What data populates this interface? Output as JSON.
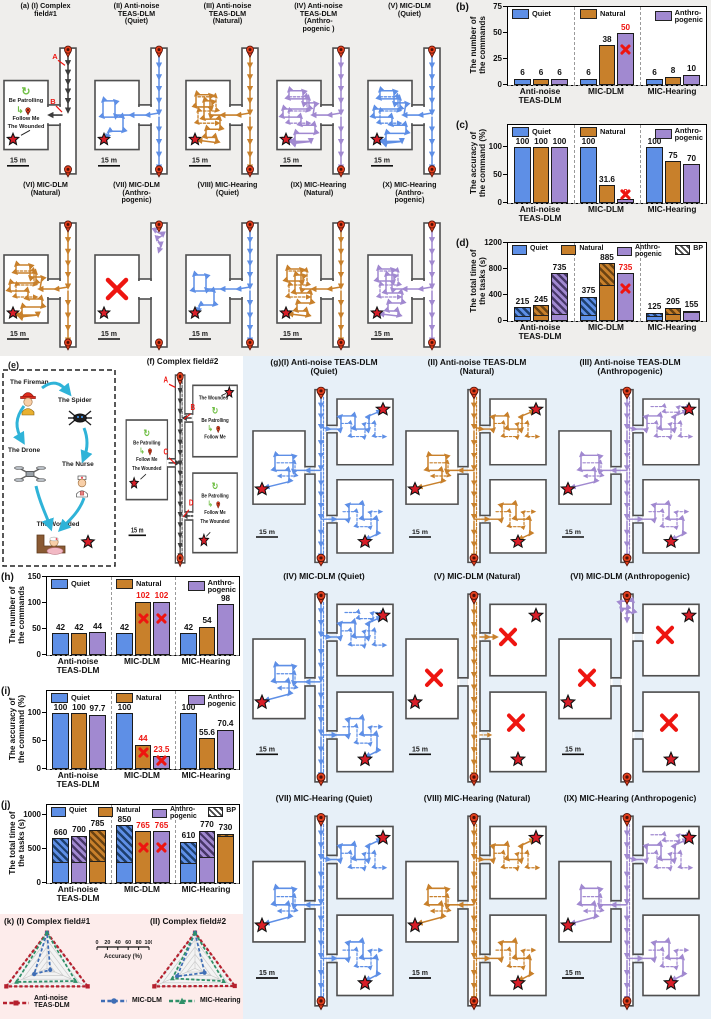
{
  "colors": {
    "blue": "#5e8fe6",
    "orange": "#c8802b",
    "purple": "#a189d0",
    "red": "#ee1510",
    "green": "#6fbe44",
    "cyan": "#2fb3d8",
    "blue_dark": "#1d3f6e",
    "orange_dark": "#6a4312",
    "purple_dark": "#473668",
    "wall": "#4f4f4f",
    "black_traj": "#3c3c3c",
    "star": "#d81e28",
    "pin": "#e2401d",
    "bg_top": "#efeeec",
    "bg_g": "#e7f0f8",
    "bg_k": "#fdeceb",
    "radar_red": "#b6202e",
    "radar_blue": "#3f6eb5",
    "radar_green": "#2f9068"
  },
  "strings": {
    "scale": "15 m",
    "patrol": "Be Patrolling",
    "follow": "Follow Me",
    "wounded": "The Wounded"
  },
  "panel_a": {
    "maps": [
      {
        "label": "(a) (I) Complex\nfield#1",
        "color": "ref",
        "variant": "ref",
        "markers": [
          "A",
          "B"
        ]
      },
      {
        "label": "(II) Anti-noise\nTEAS-DLM\n(Quiet)",
        "color": "blue",
        "variant": "full",
        "density": "q"
      },
      {
        "label": "(III) Anti-noise\nTEAS-DLM\n(Natural)",
        "color": "orange",
        "variant": "full",
        "density": "n"
      },
      {
        "label": "(IV) Anti-noise\nTEAS-DLM\n(Anthro-\npogenic )",
        "color": "purple",
        "variant": "full",
        "density": "a"
      },
      {
        "label": "(V) MIC-DLM\n(Quiet)",
        "color": "blue",
        "variant": "full",
        "density": "a"
      },
      {
        "label": "(VI) MIC-DLM\n(Natural)",
        "color": "orange",
        "variant": "full",
        "density": "a"
      },
      {
        "label": "(VII) MIC-DLM\n(Anthro-\npogenic)",
        "color": "purple",
        "variant": "fail",
        "density": "q"
      },
      {
        "label": "(VIII) MIC-Hearing\n(Quiet)",
        "color": "blue",
        "variant": "full",
        "density": "q"
      },
      {
        "label": "(IX) MIC-Hearing\n(Natural)",
        "color": "orange",
        "variant": "full",
        "density": "n"
      },
      {
        "label": "(X) MIC-Hearing\n(Anthro-\npogenic)",
        "color": "purple",
        "variant": "full",
        "density": "n"
      }
    ]
  },
  "panel_e": {
    "label": "(e)",
    "items": [
      {
        "name": "The Fireman",
        "icon": "fireman-icon"
      },
      {
        "name": "The Spider",
        "icon": "spider-icon"
      },
      {
        "name": "The Drone",
        "icon": "drone-icon"
      },
      {
        "name": "The Nurse",
        "icon": "nurse-icon"
      },
      {
        "name": "The Wounded",
        "icon": "wounded-icon"
      }
    ]
  },
  "panel_f": {
    "label": "(f)",
    "title": "Complex field#2",
    "markers": [
      "A",
      "B",
      "C",
      "D"
    ]
  },
  "panel_g": {
    "maps": [
      {
        "label": "(g)(I) Anti-noise TEAS-DLM\n(Quiet)",
        "color": "blue",
        "variant": "full",
        "density": "q"
      },
      {
        "label": "(II) Anti-noise TEAS-DLM\n(Natural)",
        "color": "orange",
        "variant": "full",
        "density": "n"
      },
      {
        "label": "(III) Anti-noise TEAS-DLM\n(Anthropogenic)",
        "color": "purple",
        "variant": "full",
        "density": "a"
      },
      {
        "label": "(IV) MIC-DLM (Quiet)",
        "color": "blue",
        "variant": "full",
        "density": "a"
      },
      {
        "label": "(V) MIC-DLM (Natural)",
        "color": "orange",
        "variant": "partial",
        "density": "q"
      },
      {
        "label": "(VI) MIC-DLM (Anthropogenic)",
        "color": "purple",
        "variant": "stub",
        "density": "q"
      },
      {
        "label": "(VII) MIC-Hearing (Quiet)",
        "color": "blue",
        "variant": "full",
        "density": "n"
      },
      {
        "label": "(VIII) MIC-Hearing (Natural)",
        "color": "orange",
        "variant": "full",
        "density": "n"
      },
      {
        "label": "(IX) MIC-Hearing (Anthropogenic)",
        "color": "purple",
        "variant": "full",
        "density": "a"
      }
    ]
  },
  "chart_data": [
    {
      "id": "b",
      "panel": "(b)",
      "type": "bar",
      "ylabel": "The number of\nthe commands",
      "ylim": [
        0,
        75
      ],
      "yticks": [
        0,
        25,
        50,
        75
      ],
      "legend": [
        {
          "label": "Quiet",
          "color": "blue"
        },
        {
          "label": "Natural",
          "color": "orange"
        },
        {
          "label": "Anthro-\npogenic",
          "color": "purple"
        }
      ],
      "categories": [
        "Anti-noise\nTEAS-DLM",
        "MIC-DLM",
        "MIC-Hearing"
      ],
      "groups": [
        [
          {
            "v": 6
          },
          {
            "v": 6
          },
          {
            "v": 6
          }
        ],
        [
          {
            "v": 6
          },
          {
            "v": 38
          },
          {
            "v": 50,
            "fail": true,
            "red": true
          }
        ],
        [
          {
            "v": 6
          },
          {
            "v": 8
          },
          {
            "v": 10
          }
        ]
      ]
    },
    {
      "id": "c",
      "panel": "(c)",
      "type": "bar",
      "ylabel": "The accuracy of\nthe command (%)",
      "ylim": [
        0,
        140
      ],
      "yticks": [
        0,
        50,
        100
      ],
      "legend": [
        {
          "label": "Quiet",
          "color": "blue"
        },
        {
          "label": "Natural",
          "color": "orange"
        },
        {
          "label": "Anthro-\npogenic",
          "color": "purple"
        }
      ],
      "categories": [
        "Anti-noise\nTEAS-DLM",
        "MIC-DLM",
        "MIC-Hearing"
      ],
      "groups": [
        [
          {
            "v": 100
          },
          {
            "v": 100
          },
          {
            "v": 100
          }
        ],
        [
          {
            "v": 100
          },
          {
            "v": 31.6
          },
          {
            "v": 8,
            "fail": true,
            "red": true
          }
        ],
        [
          {
            "v": 100
          },
          {
            "v": 75
          },
          {
            "v": 70
          }
        ]
      ]
    },
    {
      "id": "d",
      "panel": "(d)",
      "type": "bar",
      "ylabel": "The total time of\nthe tasks (s)",
      "ylim": [
        0,
        1200
      ],
      "yticks": [
        0,
        400,
        800,
        1200
      ],
      "legend": [
        {
          "label": "Quiet",
          "color": "blue"
        },
        {
          "label": "Natural",
          "color": "orange"
        },
        {
          "label": "Anthro-\npogenic",
          "color": "purple"
        },
        {
          "label": "BP",
          "hatch": true
        }
      ],
      "categories": [
        "Anti-noise\nTEAS-DLM",
        "MIC-DLM",
        "MIC-Hearing"
      ],
      "groups": [
        [
          {
            "v": 215,
            "hf": 0.72
          },
          {
            "v": 245,
            "hf": 0.7
          },
          {
            "v": 735,
            "hf": 0.9
          }
        ],
        [
          {
            "v": 375,
            "hf": 0.8
          },
          {
            "v": 885,
            "hf": 0.38
          },
          {
            "v": 735,
            "fail": true,
            "red": true
          }
        ],
        [
          {
            "v": 125,
            "hf": 0.5
          },
          {
            "v": 205,
            "hf": 0.55
          },
          {
            "v": 155,
            "hf": 0.08
          }
        ]
      ]
    },
    {
      "id": "h",
      "panel": "(h)",
      "type": "bar",
      "ylabel": "The number of\nthe commands",
      "ylim": [
        0,
        150
      ],
      "yticks": [
        0,
        50,
        100,
        150
      ],
      "legend": [
        {
          "label": "Quiet",
          "color": "blue"
        },
        {
          "label": "Natural",
          "color": "orange"
        },
        {
          "label": "Anthro-\npogenic",
          "color": "purple"
        }
      ],
      "categories": [
        "Anti-noise\nTEAS-DLM",
        "MIC-DLM",
        "MIC-Hearing"
      ],
      "groups": [
        [
          {
            "v": 42
          },
          {
            "v": 42
          },
          {
            "v": 44
          }
        ],
        [
          {
            "v": 42
          },
          {
            "v": 102,
            "fail": true,
            "red": true
          },
          {
            "v": 102,
            "fail": true,
            "red": true
          }
        ],
        [
          {
            "v": 42
          },
          {
            "v": 54
          },
          {
            "v": 98
          }
        ]
      ]
    },
    {
      "id": "i",
      "panel": "(i)",
      "type": "bar",
      "ylabel": "The accuracy of\nthe command (%)",
      "ylim": [
        0,
        140
      ],
      "yticks": [
        0,
        50,
        100
      ],
      "legend": [
        {
          "label": "Quiet",
          "color": "blue"
        },
        {
          "label": "Natural",
          "color": "orange"
        },
        {
          "label": "Anthro-\npogenic",
          "color": "purple"
        }
      ],
      "categories": [
        "Anti-noise\nTEAS-DLM",
        "MIC-DLM",
        "MIC-Hearing"
      ],
      "groups": [
        [
          {
            "v": 100
          },
          {
            "v": 100
          },
          {
            "v": 97.7
          }
        ],
        [
          {
            "v": 100
          },
          {
            "v": 44,
            "fail": true,
            "red": true
          },
          {
            "v": 23.5,
            "fail": true,
            "red": true
          }
        ],
        [
          {
            "v": 100
          },
          {
            "v": 55.6
          },
          {
            "v": 70.4
          }
        ]
      ]
    },
    {
      "id": "j",
      "panel": "(j)",
      "type": "bar",
      "ylabel": "The total time of\nthe tasks (s)",
      "ylim": [
        0,
        1150
      ],
      "yticks": [
        0,
        500,
        1000
      ],
      "legend": [
        {
          "label": "Quiet",
          "color": "blue"
        },
        {
          "label": "Natural",
          "color": "orange"
        },
        {
          "label": "Anthro-\npogenic",
          "color": "purple"
        },
        {
          "label": "BP",
          "hatch": true
        }
      ],
      "categories": [
        "Anti-noise\nTEAS-DLM",
        "MIC-DLM",
        "MIC-Hearing"
      ],
      "groups": [
        [
          {
            "v": 660,
            "hf": 0.56
          },
          {
            "v": 700,
            "hf": 0.58,
            "ck": "purple"
          },
          {
            "v": 785,
            "hf": 0.6,
            "ck": "orange"
          }
        ],
        [
          {
            "v": 850,
            "hf": 0.66
          },
          {
            "v": 765,
            "fail": true,
            "red": true
          },
          {
            "v": 765,
            "fail": true,
            "red": true,
            "ck": "purple"
          }
        ],
        [
          {
            "v": 610,
            "hf": 0.55
          },
          {
            "v": 770,
            "hf": 0.52,
            "ck": "purple"
          },
          {
            "v": 730,
            "hf": 0.05,
            "ck": "orange"
          }
        ]
      ]
    },
    {
      "id": "k",
      "panel": "(k)",
      "type": "radar",
      "titles": [
        "(k) (I) Complex field#1",
        "(II) Complex field#2"
      ],
      "axes": [
        "Quiet",
        "Natural",
        "Anthropogenic"
      ],
      "scale": {
        "ticks": [
          "0",
          "20",
          "40",
          "60",
          "80",
          "100"
        ],
        "label": "Accuracy (%)"
      },
      "series": [
        {
          "name": "Anti-noise\nTEAS-DLM",
          "color": "#b6202e",
          "marker": "square",
          "field1": [
            100,
            100,
            100
          ],
          "field2": [
            100,
            100,
            97.7
          ]
        },
        {
          "name": "MIC-DLM",
          "color": "#3f6eb5",
          "marker": "circle",
          "field1": [
            100,
            31.6,
            8
          ],
          "field2": [
            100,
            44,
            23.5
          ]
        },
        {
          "name": "MIC-Hearing",
          "color": "#2f9068",
          "marker": "triangle",
          "field1": [
            100,
            75,
            70
          ],
          "field2": [
            100,
            55.6,
            70.4
          ]
        }
      ]
    }
  ]
}
